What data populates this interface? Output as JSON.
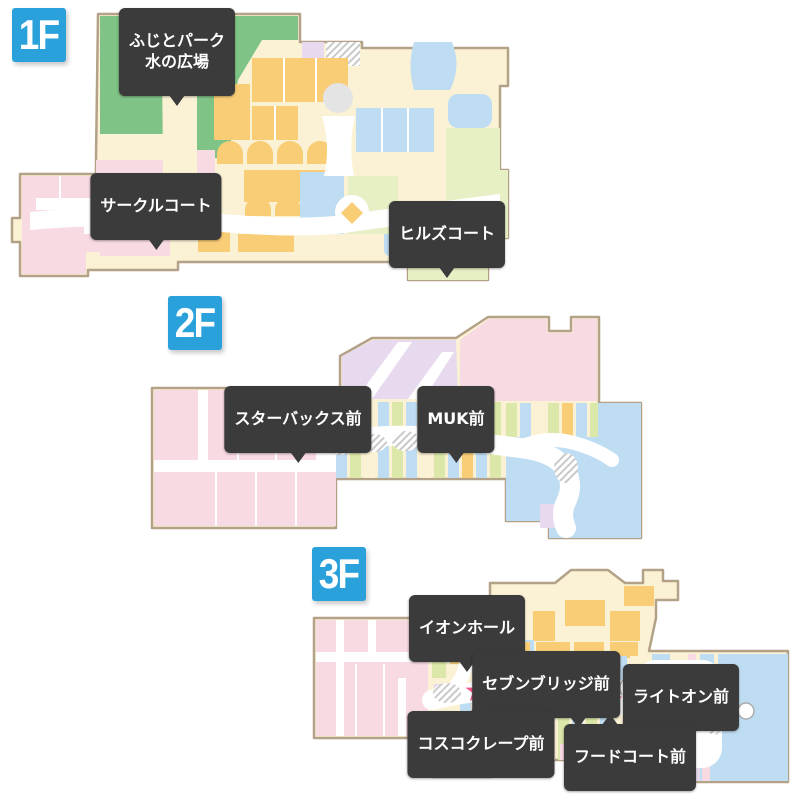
{
  "colors": {
    "floor-badge": "#2AA1DB",
    "label-bg": "#3B3B3B",
    "label-text": "#FFFFFF",
    "star": "#F2548C",
    "map-border": "#B3A287",
    "zone-cream": "#FBF2D5",
    "zone-pink": "#F8DBE2",
    "zone-orange": "#F9CD76",
    "zone-blue": "#BFDDF2",
    "zone-green": "#7FC486",
    "zone-lightgreen": "#E7EFC4",
    "zone-stripe-green": "#DCE8A9",
    "zone-lavender": "#E7DAEE",
    "zone-gray": "#E4E4E4",
    "corridor": "#FFFFFF"
  },
  "floors": [
    {
      "badge": "1F",
      "markers": [
        {
          "name": "fujito-park-mizu-no-hiroba",
          "label": "ふじとパーク\n水の広場"
        },
        {
          "name": "circle-court",
          "label": "サークルコート"
        },
        {
          "name": "hills-court",
          "label": "ヒルズコート"
        }
      ]
    },
    {
      "badge": "2F",
      "markers": [
        {
          "name": "starbucks-mae",
          "label": "スターバックス前"
        },
        {
          "name": "muk-mae",
          "label": "MUK前"
        }
      ]
    },
    {
      "badge": "3F",
      "markers": [
        {
          "name": "aeon-hall",
          "label": "イオンホール"
        },
        {
          "name": "seven-bridge-mae",
          "label": "セブンブリッジ前"
        },
        {
          "name": "right-on-mae",
          "label": "ライトオン前"
        },
        {
          "name": "cosco-crepe-mae",
          "label": "コスコクレープ前"
        },
        {
          "name": "food-court-mae",
          "label": "フードコート前"
        }
      ]
    }
  ]
}
